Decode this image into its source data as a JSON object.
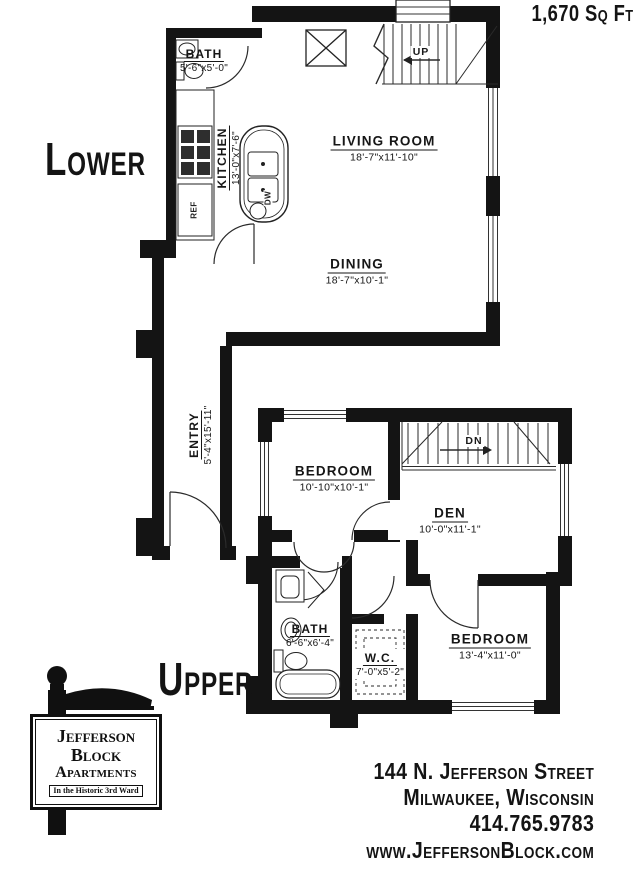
{
  "area_label": "1,670 Sq Ft",
  "colors": {
    "ink": "#141414",
    "paper": "#ffffff"
  },
  "floors": {
    "lower": {
      "label": "Lower",
      "stair_label": "UP",
      "appliances": {
        "ref": "REF",
        "dw": "DW"
      },
      "rooms": [
        {
          "name": "BATH",
          "dims": "5'-6\"x5'-0\""
        },
        {
          "name": "KITCHEN",
          "dims": "13'-0\"x7'-6\""
        },
        {
          "name": "LIVING ROOM",
          "dims": "18'-7\"x11'-10\""
        },
        {
          "name": "DINING",
          "dims": "18'-7\"x10'-1\""
        },
        {
          "name": "ENTRY",
          "dims": "5'-4\"x15'-11\""
        }
      ]
    },
    "upper": {
      "label": "Upper",
      "stair_label": "DN",
      "rooms": [
        {
          "name": "BEDROOM",
          "dims": "10'-10\"x10'-1\""
        },
        {
          "name": "DEN",
          "dims": "10'-0\"x11'-1\""
        },
        {
          "name": "BATH",
          "dims": "6'-6\"x6'-4\""
        },
        {
          "name": "W.C.",
          "dims": "7'-0\"x5'-2\""
        },
        {
          "name": "BEDROOM",
          "dims": "13'-4\"x11'-0\""
        }
      ]
    }
  },
  "sign": {
    "line1": "Jefferson",
    "line2": "Block",
    "line3": "Apartments",
    "tagline": "In the Historic 3rd Ward"
  },
  "contact": {
    "address": "144 N. Jefferson Street",
    "city": "Milwaukee, Wisconsin",
    "phone": "414.765.9783",
    "website": "www.JeffersonBlock.com"
  }
}
